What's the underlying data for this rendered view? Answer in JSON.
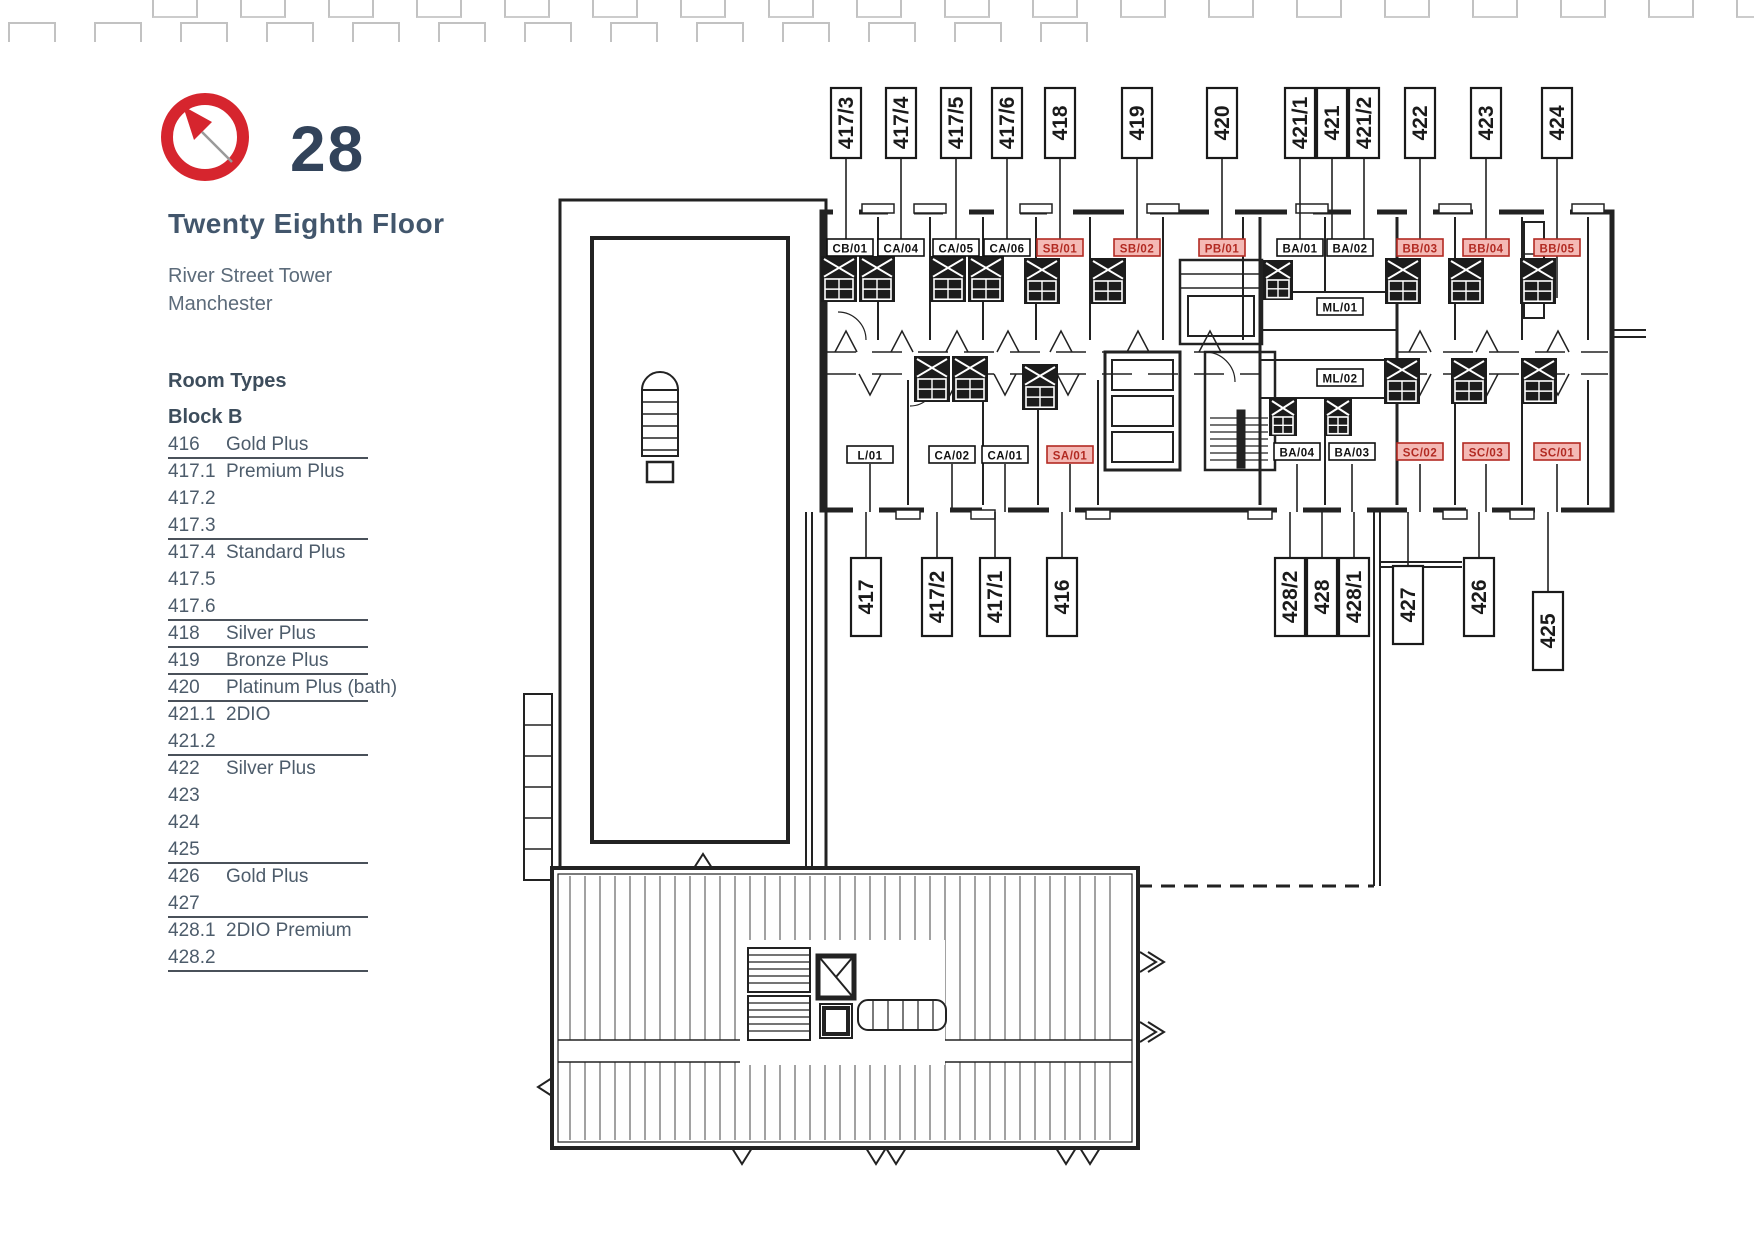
{
  "header": {
    "floor_number": "28",
    "floor_name": "Twenty Eighth Floor",
    "building": "River Street Tower",
    "city": "Manchester",
    "accent_red": "#d6252e",
    "navy": "#32435a"
  },
  "room_types": {
    "heading": "Room Types",
    "block": "Block B",
    "rows": [
      {
        "num": "416",
        "type": "Gold Plus",
        "underlined": true
      },
      {
        "num": "417.1",
        "type": "Premium Plus",
        "underlined": false
      },
      {
        "num": "417.2",
        "type": "",
        "underlined": false
      },
      {
        "num": "417.3",
        "type": "",
        "underlined": true
      },
      {
        "num": "417.4",
        "type": "Standard Plus",
        "underlined": false
      },
      {
        "num": "417.5",
        "type": "",
        "underlined": false
      },
      {
        "num": "417.6",
        "type": "",
        "underlined": true
      },
      {
        "num": "418",
        "type": "Silver Plus",
        "underlined": true
      },
      {
        "num": "419",
        "type": "Bronze Plus",
        "underlined": true
      },
      {
        "num": "420",
        "type": "Platinum Plus (bath)",
        "underlined": true
      },
      {
        "num": "421.1",
        "type": "2DIO",
        "underlined": false
      },
      {
        "num": "421.2",
        "type": "",
        "underlined": true
      },
      {
        "num": "422",
        "type": "Silver Plus",
        "underlined": false
      },
      {
        "num": "423",
        "type": "",
        "underlined": false
      },
      {
        "num": "424",
        "type": "",
        "underlined": false
      },
      {
        "num": "425",
        "type": "",
        "underlined": true
      },
      {
        "num": "426",
        "type": "Gold Plus",
        "underlined": false
      },
      {
        "num": "427",
        "type": "",
        "underlined": true
      },
      {
        "num": "428.1",
        "type": "2DIO Premium",
        "underlined": false
      },
      {
        "num": "428.2",
        "type": "",
        "underlined": true
      }
    ]
  },
  "plan": {
    "top_labels": [
      "417/3",
      "417/4",
      "417/5",
      "417/6",
      "418",
      "419",
      "420",
      "421/1",
      "421",
      "421/2",
      "422",
      "423",
      "424"
    ],
    "bottom_labels": [
      "417",
      "417/2",
      "417/1",
      "416",
      "428/2",
      "428",
      "428/1",
      "427",
      "426",
      "425"
    ],
    "unit_labels": [
      {
        "text": "CB/01",
        "red": false
      },
      {
        "text": "CA/04",
        "red": false
      },
      {
        "text": "CA/05",
        "red": false
      },
      {
        "text": "CA/06",
        "red": false
      },
      {
        "text": "SB/01",
        "red": true
      },
      {
        "text": "SB/02",
        "red": true
      },
      {
        "text": "PB/01",
        "red": true
      },
      {
        "text": "BA/01",
        "red": false
      },
      {
        "text": "BA/02",
        "red": false
      },
      {
        "text": "BB/03",
        "red": true
      },
      {
        "text": "BB/04",
        "red": true
      },
      {
        "text": "BB/05",
        "red": true
      },
      {
        "text": "ML/01",
        "red": false
      },
      {
        "text": "ML/02",
        "red": false
      },
      {
        "text": "L/01",
        "red": false
      },
      {
        "text": "CA/02",
        "red": false
      },
      {
        "text": "CA/01",
        "red": false
      },
      {
        "text": "SA/01",
        "red": true
      },
      {
        "text": "BA/04",
        "red": false
      },
      {
        "text": "BA/03",
        "red": false
      },
      {
        "text": "SC/02",
        "red": true
      },
      {
        "text": "SC/03",
        "red": true
      },
      {
        "text": "SC/01",
        "red": true
      }
    ],
    "red_label_bg": "#f4b9b5",
    "red_label_ink": "#b22a22",
    "line_ink": "#222222"
  }
}
